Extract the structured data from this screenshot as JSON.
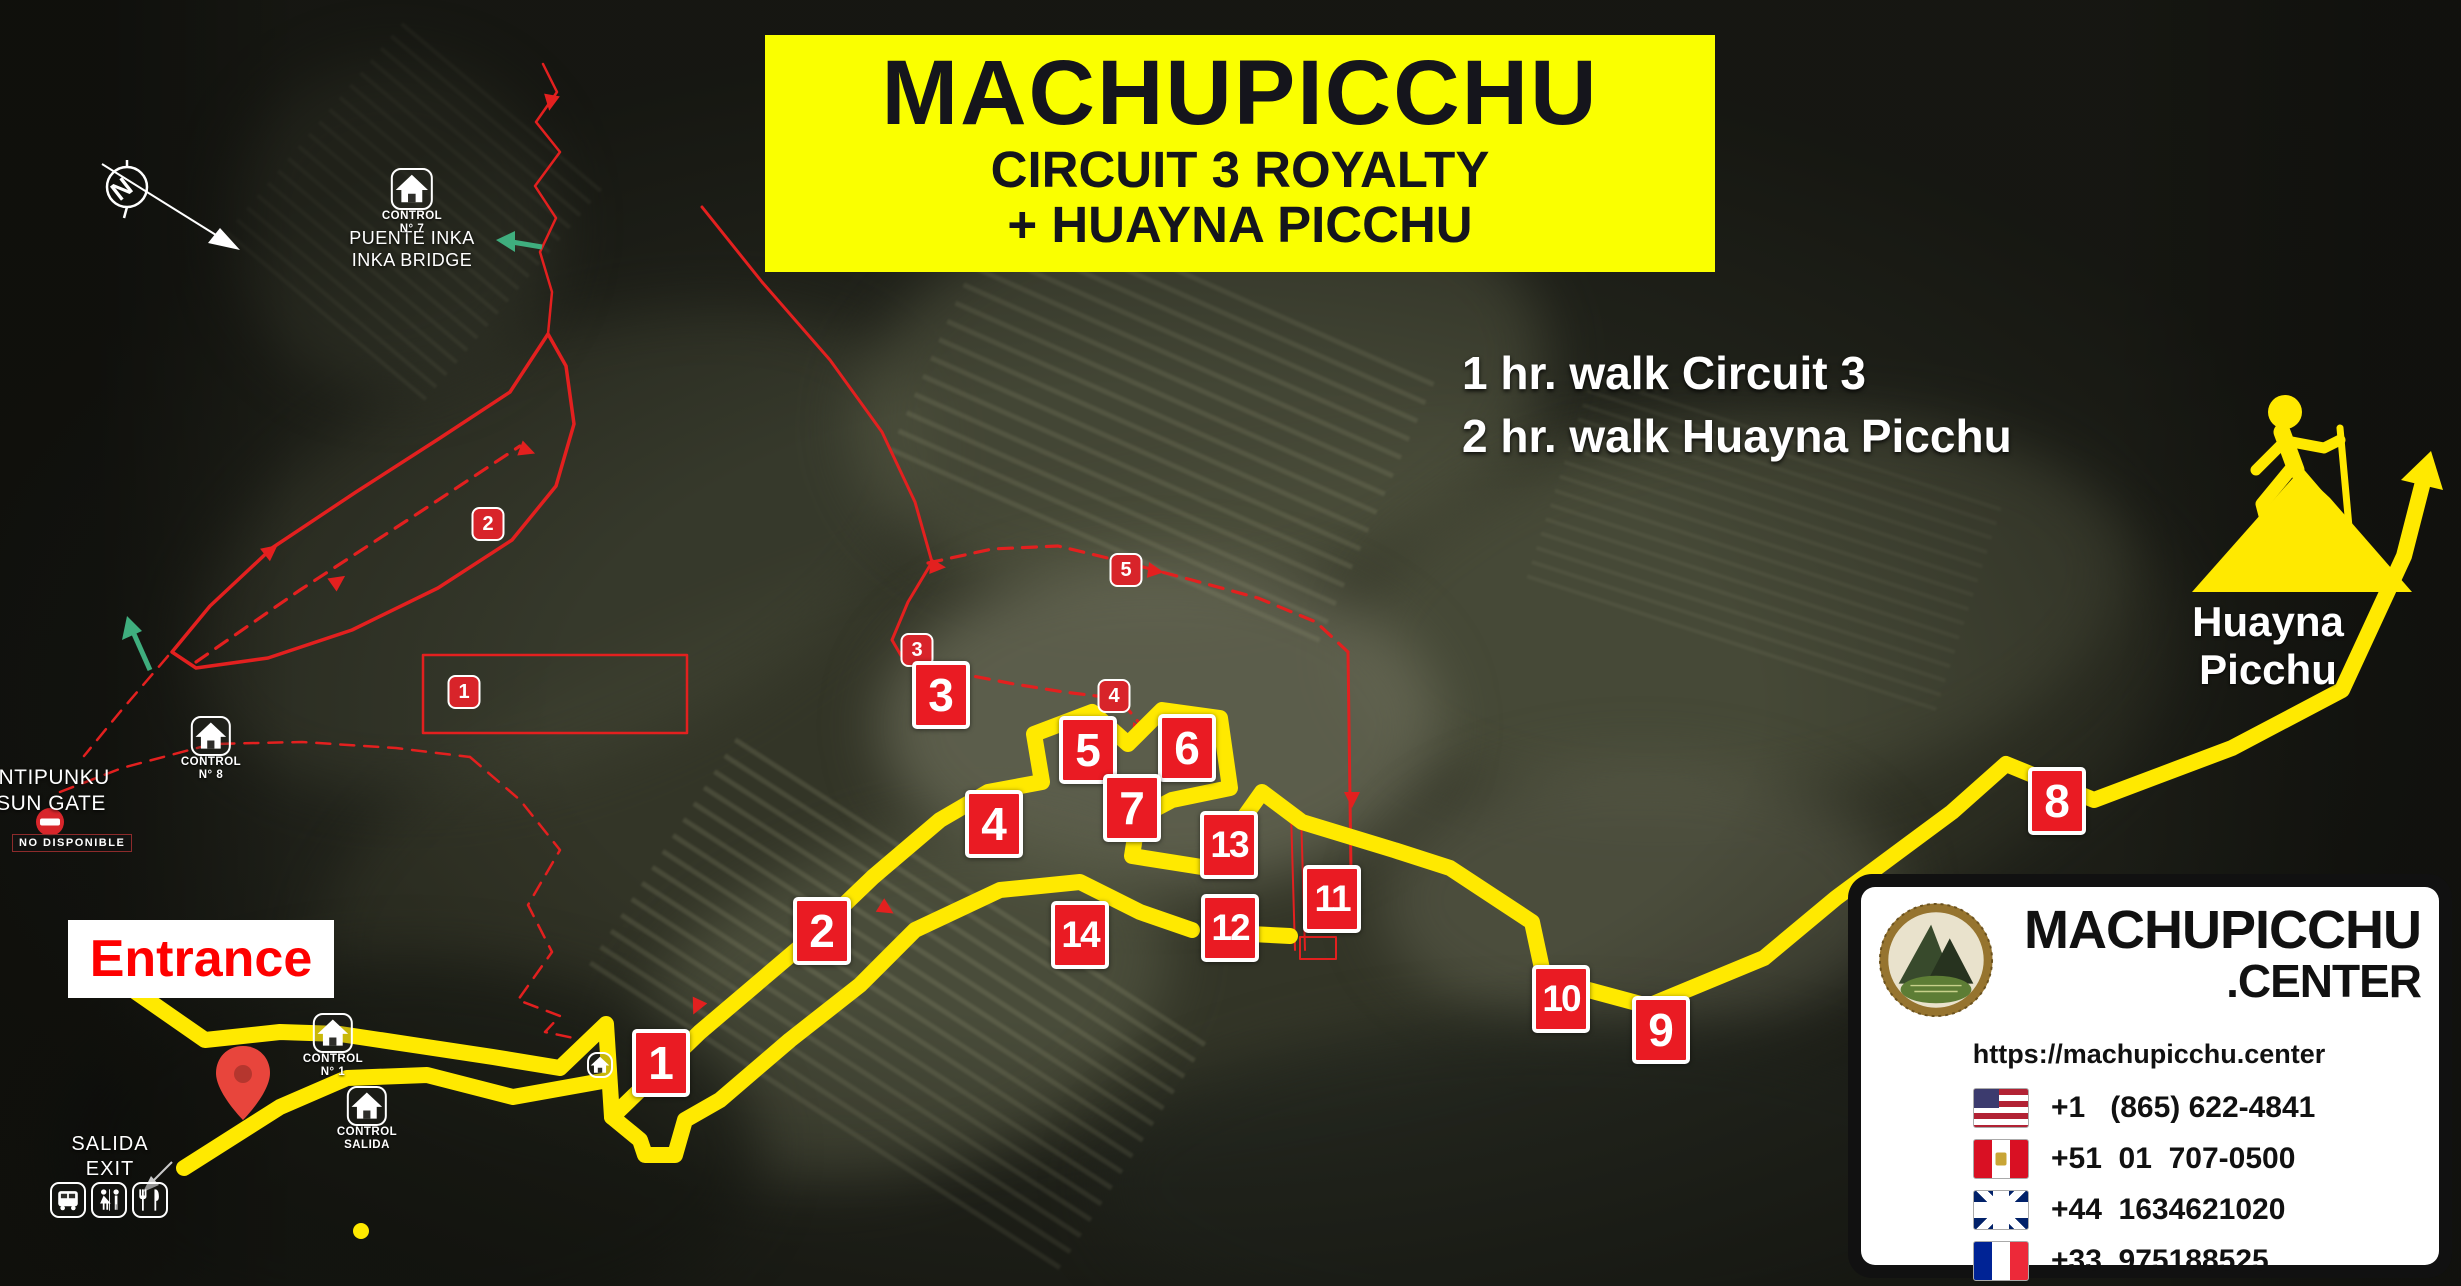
{
  "title": {
    "line1": "MACHUPICCHU",
    "line2": "CIRCUIT 3 ROYALTY",
    "line3": "+ HUAYNA PICCHU"
  },
  "walk_info": {
    "line1": "1 hr. walk Circuit 3",
    "line2": "2 hr. walk Huayna Picchu"
  },
  "huayna_picchu_label": "Huayna Picchu",
  "entrance_label": "Entrance",
  "exit_label": {
    "line1": "SALIDA",
    "line2": "EXIT"
  },
  "sun_gate": {
    "line1": "INTIPUNKU",
    "line2": "SUN GATE",
    "status": "NO DISPONIBLE"
  },
  "inka_bridge": {
    "line1": "PUENTE INKA",
    "line2": "INKA BRIDGE"
  },
  "compass_letter": "N",
  "waypoints": [
    {
      "label": "1",
      "x": 661,
      "y": 1063
    },
    {
      "label": "2",
      "x": 822,
      "y": 931
    },
    {
      "label": "3",
      "x": 941,
      "y": 695
    },
    {
      "label": "4",
      "x": 994,
      "y": 824
    },
    {
      "label": "5",
      "x": 1088,
      "y": 750
    },
    {
      "label": "6",
      "x": 1187,
      "y": 748
    },
    {
      "label": "7",
      "x": 1132,
      "y": 808
    },
    {
      "label": "8",
      "x": 2057,
      "y": 801
    },
    {
      "label": "9",
      "x": 1661,
      "y": 1030
    },
    {
      "label": "10",
      "x": 1561,
      "y": 999
    },
    {
      "label": "11",
      "x": 1332,
      "y": 899
    },
    {
      "label": "12",
      "x": 1230,
      "y": 928
    },
    {
      "label": "13",
      "x": 1229,
      "y": 845
    },
    {
      "label": "14",
      "x": 1080,
      "y": 935
    }
  ],
  "mini_markers": [
    {
      "label": "1",
      "x": 464,
      "y": 692
    },
    {
      "label": "2",
      "x": 488,
      "y": 524
    },
    {
      "label": "3",
      "x": 917,
      "y": 650
    },
    {
      "label": "4",
      "x": 1114,
      "y": 696
    },
    {
      "label": "5",
      "x": 1126,
      "y": 570
    }
  ],
  "controls": [
    {
      "name": "control-7-bridge",
      "line1": "CONTROL",
      "line2": "N° 7",
      "x": 412,
      "top": 168,
      "size": 42
    },
    {
      "name": "control-8",
      "line1": "CONTROL",
      "line2": "N° 8",
      "x": 211,
      "top": 716,
      "size": 40
    },
    {
      "name": "control-1",
      "line1": "CONTROL",
      "line2": "N° 1",
      "x": 333,
      "top": 1013,
      "size": 40
    },
    {
      "name": "control-salida",
      "line1": "CONTROL",
      "line2": "SALIDA",
      "x": 367,
      "top": 1086,
      "size": 40
    },
    {
      "name": "control-house-small",
      "line1": "",
      "line2": "",
      "x": 600,
      "top": 1052,
      "size": 26
    }
  ],
  "facilities": [
    {
      "icon": "bus-icon"
    },
    {
      "icon": "restroom-icon"
    },
    {
      "icon": "restaurant-icon"
    }
  ],
  "contact": {
    "brand_line1": "MACHUPICCHU",
    "brand_line2": ".CENTER",
    "url": "https://machupicchu.center",
    "phones": [
      {
        "flag": "us",
        "number": "+1   (865) 622-4841"
      },
      {
        "flag": "pe",
        "number": "+51  01  707-0500"
      },
      {
        "flag": "uk",
        "number": "+44  1634621020"
      },
      {
        "flag": "fr",
        "number": "+33  975188525"
      }
    ]
  },
  "colors": {
    "route_yellow": "#ffe900",
    "route_red": "#e3201f",
    "marker_red": "#ea1b23",
    "title_bg": "#faff00",
    "entrance_red": "#fe0000"
  }
}
